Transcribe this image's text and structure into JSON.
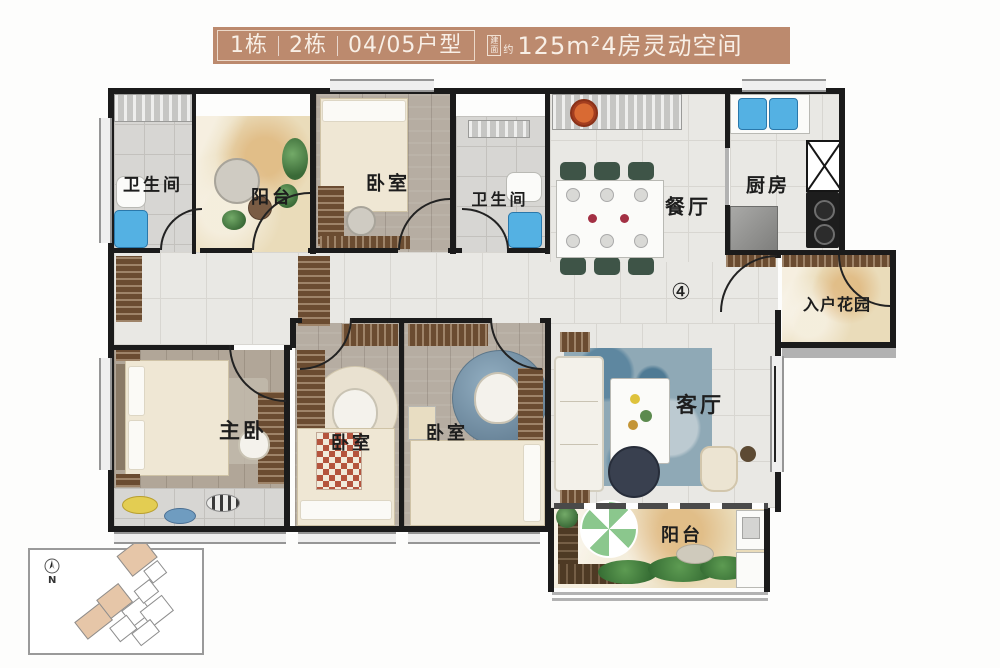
{
  "banner": {
    "segments": [
      "1栋",
      "2栋",
      "04/05户型"
    ],
    "area_stamp_top": "建",
    "area_stamp_bottom": "面",
    "area_stamp_side": "约",
    "area_text": "125m²4房灵动空间",
    "bg_color": "#bc8a6e",
    "text_color": "#f8efe6"
  },
  "rooms": {
    "bathroom_top_left": "卫生间",
    "balcony_top": "阳台",
    "bedroom_top": "卧室",
    "bathroom_top_right": "卫生间",
    "dining": "餐厅",
    "kitchen": "厨房",
    "entry_garden": "入户花园",
    "master_bedroom": "主卧",
    "bedroom_left": "卧室",
    "bedroom_mid": "卧室",
    "living": "客厅",
    "balcony_bottom": "阳台"
  },
  "marker": {
    "unit_number": "④"
  },
  "inset": {
    "north_label": "N"
  },
  "colors": {
    "wall": "#1b1b1b",
    "banner_copper": "#bc8a6e",
    "marble_floor": "#eadcba",
    "wood_floor": "#b6ada2",
    "tile_floor": "#e9e8e4",
    "water_blue": "#54b1e3",
    "wardrobe_brown": "#6b4c31",
    "rug_blue": "#8fa9b6",
    "plant_green": "#3c6b38",
    "site_block_tan": "#e6c6a8"
  }
}
